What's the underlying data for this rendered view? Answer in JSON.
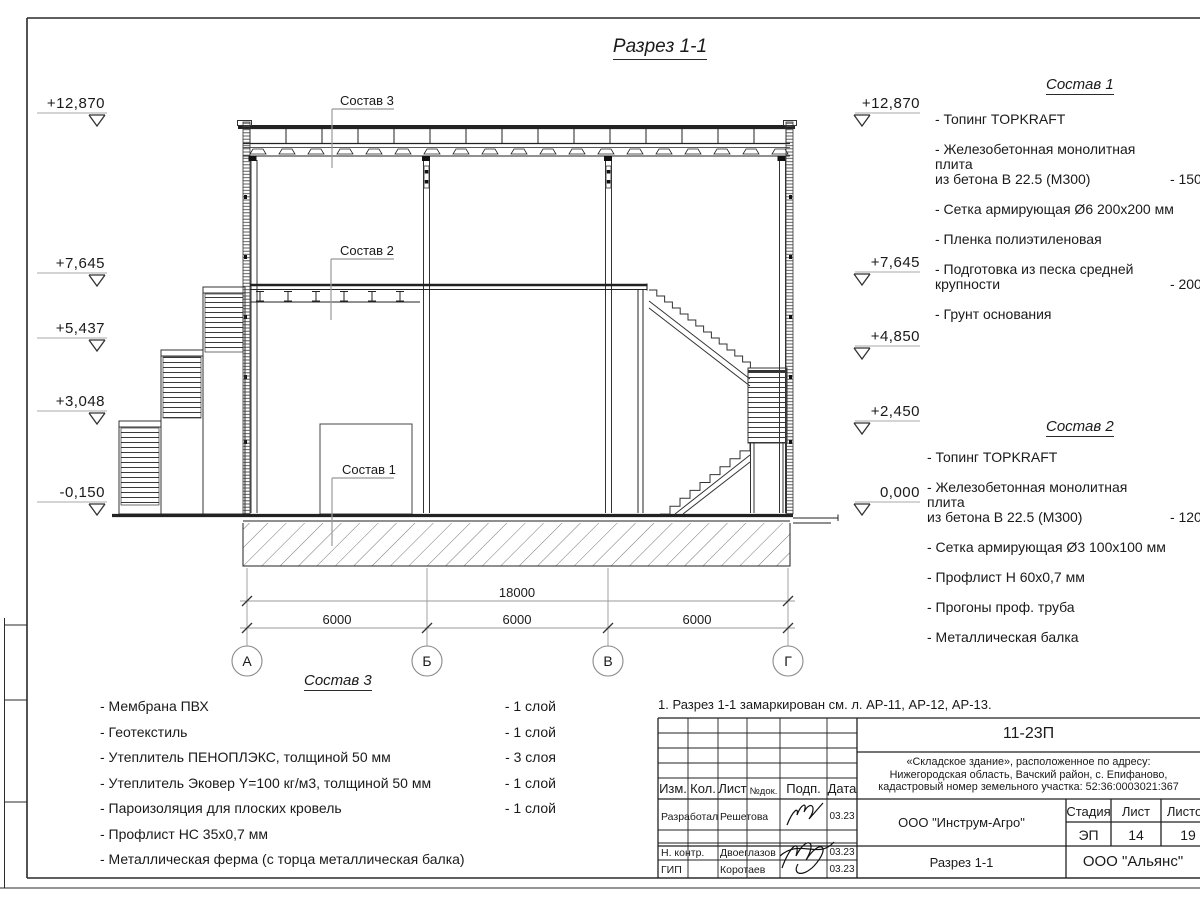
{
  "title": "Разрез 1-1",
  "marks_left": [
    "+12,870",
    "+7,645",
    "+5,437",
    "+3,048",
    "-0,150"
  ],
  "marks_right": [
    "+12,870",
    "+7,645",
    "+4,850",
    "+2,450",
    "0,000"
  ],
  "axes": [
    "А",
    "Б",
    "В",
    "Г"
  ],
  "dims": {
    "total": "18000",
    "bays": [
      "6000",
      "6000",
      "6000"
    ]
  },
  "leaders": {
    "s1": "Состав 1",
    "s2": "Состав 2",
    "s3": "Состав 3"
  },
  "sostav1": {
    "title": "Состав 1",
    "items": [
      {
        "text": "- Топинг TOPKRAFT",
        "value": ""
      },
      {
        "text": "- Железобетонная  монолитная плита\nиз бетона  В 22.5 (М300)",
        "value": "- 150 мм"
      },
      {
        "text": "- Сетка армирующая Ø6 200х200 мм",
        "value": ""
      },
      {
        "text": "- Пленка полиэтиленовая",
        "value": ""
      },
      {
        "text": "- Подготовка из песка средней\nкрупности",
        "value": "- 200 мм"
      },
      {
        "text": "- Грунт основания",
        "value": ""
      }
    ]
  },
  "sostav2": {
    "title": "Состав 2",
    "items": [
      {
        "text": "- Топинг TOPKRAFT",
        "value": ""
      },
      {
        "text": "- Железобетонная  монолитная плита\nиз бетона  В 22.5 (М300)",
        "value": "- 120 мм"
      },
      {
        "text": "- Сетка армирующая Ø3 100х100 мм",
        "value": ""
      },
      {
        "text": "- Профлист Н 60х0,7 мм",
        "value": ""
      },
      {
        "text": "- Прогоны проф. труба",
        "value": ""
      },
      {
        "text": "- Металлическая балка",
        "value": ""
      }
    ]
  },
  "sostav3": {
    "title": "Состав 3",
    "items": [
      {
        "text": "- Мембрана ПВХ",
        "value": "- 1 слой"
      },
      {
        "text": "- Геотекстиль",
        "value": "- 1 слой"
      },
      {
        "text": "- Утеплитель ПЕНОПЛЭКС, толщиной 50 мм",
        "value": "- 3 слоя"
      },
      {
        "text": "- Утеплитель Эковер Y=100 кг/м3, толщиной 50 мм",
        "value": "- 1 слой"
      },
      {
        "text": "- Пароизоляция для плоских кровель",
        "value": "- 1 слой"
      },
      {
        "text": "- Профлист НС 35х0,7 мм",
        "value": ""
      },
      {
        "text": "- Металлическая ферма (с торца металлическая балка)",
        "value": ""
      }
    ]
  },
  "note": "1. Разрез 1-1 замаркирован см. л. АР-11, АР-12, АР-13.",
  "tb": {
    "doc_number": "11-23П",
    "project": "«Складское здание», расположенное по адресу:\nНижегородская область, Вачский район, с. Епифаново,\nкадастровый номер земельного участка: 52:36:0003021:367",
    "cols": [
      "Изм.",
      "Кол.",
      "Лист",
      "№док.",
      "Подп.",
      "Дата"
    ],
    "rows": [
      {
        "role": "Разработал",
        "name": "Решетова",
        "date": "03.23"
      },
      {
        "role": "Н. контр.",
        "name": "Двоеглазов",
        "date": "03.23"
      },
      {
        "role": "ГИП",
        "name": "Коротаев",
        "date": "03.23"
      }
    ],
    "org": "ООО \"Инструм-Агро\"",
    "stage_label": "Стадия",
    "sheet_label": "Лист",
    "sheets_label": "Листов",
    "stage": "ЭП",
    "sheet": "14",
    "sheets": "19",
    "section_name": "Разрез 1-1",
    "company": "ООО \"Альянс\""
  },
  "colors": {
    "line": "#1a1a1a",
    "leader": "#999999",
    "dim": "#8c8c8c"
  }
}
